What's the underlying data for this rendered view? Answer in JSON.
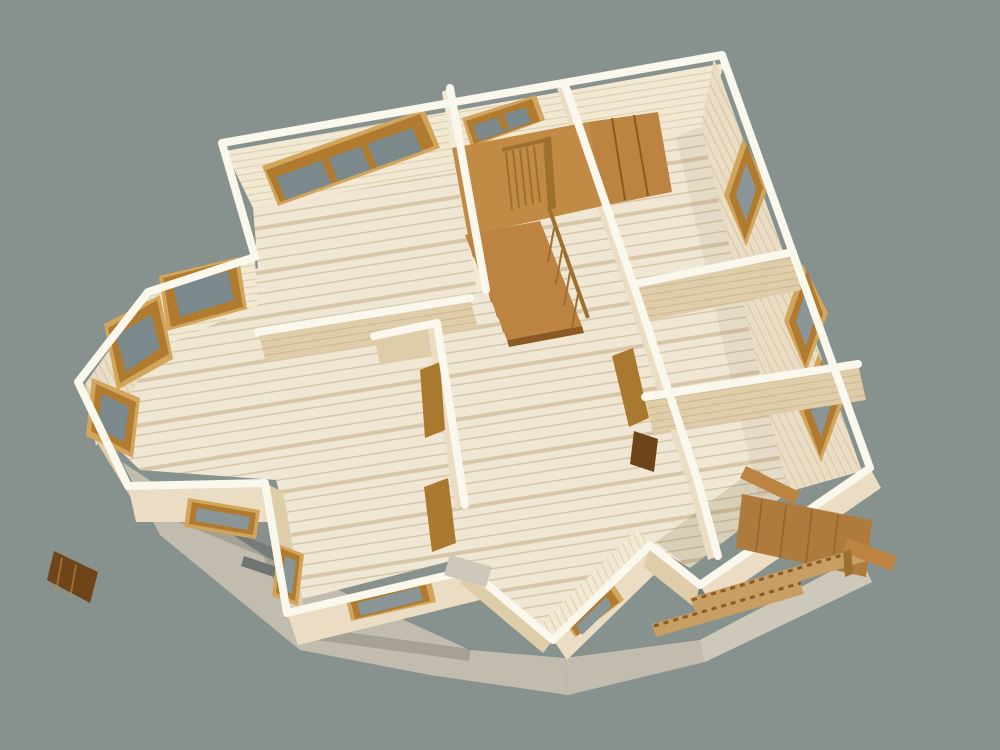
{
  "meta": {
    "title": "3D cutaway floor-plan render of a timber house",
    "view": "high-angle isometric bird's-eye view",
    "medium": "architectural 3D visualization, no text or UI controls visible"
  },
  "palette": {
    "background": "#87918E",
    "wall_top": "#FAF7EC",
    "wall_face_bright": "#F2E9D3",
    "wall_face_medium": "#EADDC4",
    "wall_face_shadow": "#DFCDAA",
    "floor_base": "#EFE7D3",
    "floor_band": "#D8C5A0",
    "glass": "#8A9597",
    "glass_dark": "#7B898C",
    "frame_light": "#D2A55C",
    "frame_brown": "#B07A2F",
    "frame_dark": "#7E5016",
    "stair_top": "#BC8440",
    "stair_front": "#8A5A22",
    "stair_landing": "#C18A45",
    "rail_wood": "#9E7030",
    "porch_wood": "#AE7B3C",
    "porch_light": "#C79E63",
    "door_wood": "#A9792F",
    "door_dark": "#6E4418",
    "concrete": "#C2BCAE",
    "concrete_light": "#CEC8BA",
    "steel": "#6F7572"
  },
  "scene": {
    "background_color": "#87918E",
    "building": "single-storey log/timber house shown without roof, interior exposed",
    "rooms": [
      {
        "id": "room-top-left",
        "note": "large room with wide 3-pane window in back wall"
      },
      {
        "id": "living-room-bay",
        "note": "room with canted bay window alcove of 3 windows on the west side"
      },
      {
        "id": "stair-hall",
        "note": "central hall with L-shaped wooden staircase, landing and balustrade"
      },
      {
        "id": "room-top-right",
        "note": "room with one diamond-set window in east wall"
      },
      {
        "id": "room-mid-right",
        "note": "small room with one window in east wall"
      },
      {
        "id": "room-bottom-right",
        "note": "room with window in east wall and porch outside"
      },
      {
        "id": "room-bottom-center",
        "note": "protruding south room with low walls and small windows"
      }
    ],
    "window_count": 12,
    "door_count": 3,
    "foundation": "grey concrete slab visible along south and west edges",
    "porch": "timber deck with sloped toothed stringers and loose boards at the south-east corner"
  }
}
